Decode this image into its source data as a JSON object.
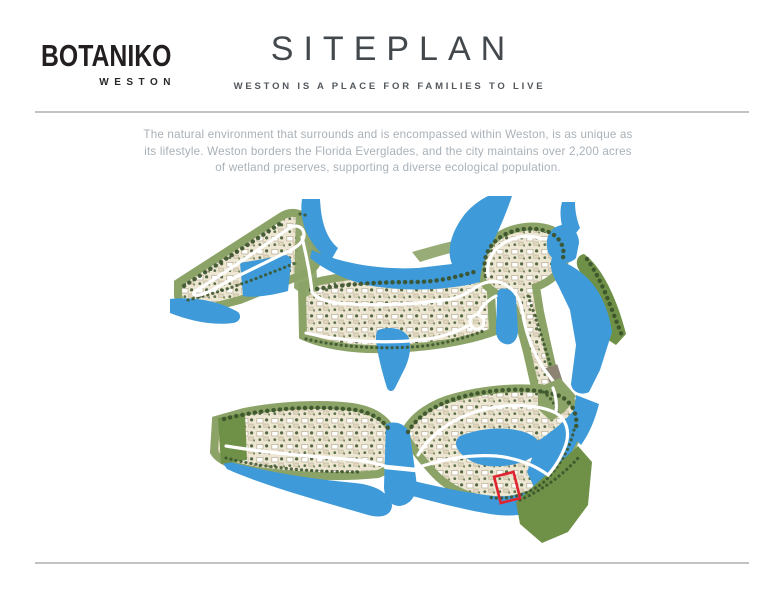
{
  "page": {
    "background": "#FFFFFF",
    "rule_color": "#ACAFB2"
  },
  "header": {
    "logo": {
      "brand": "BOTANIKO",
      "sub_brand": "WESTON"
    },
    "title": "SITEPLAN",
    "title_color": "#43484D",
    "subtitle": "WESTON IS A PLACE FOR FAMILIES TO LIVE",
    "subtitle_color": "#53585D"
  },
  "intro": {
    "color": "#A9B1B8",
    "lines": [
      "The natural environment that surrounds and is encompassed within Weston, is as unique as",
      "its lifestyle. Weston borders the Florida Everglades, and the city maintains over 2,200 acres",
      "of wetland preserves, supporting a diverse ecological population."
    ]
  },
  "map": {
    "highlight_color": "#E02430",
    "palette": {
      "water": "#3E9AD8",
      "green": "#8CA368",
      "tree": "#39522A",
      "lots": "#EDE6D2",
      "house": "#FFFFFF",
      "house_outline": "#B5AB91",
      "house_shadow": "#E2D9C0",
      "road": "#FFFFFF",
      "preserve": "#6F9147",
      "bridge": "#8C8372"
    }
  }
}
